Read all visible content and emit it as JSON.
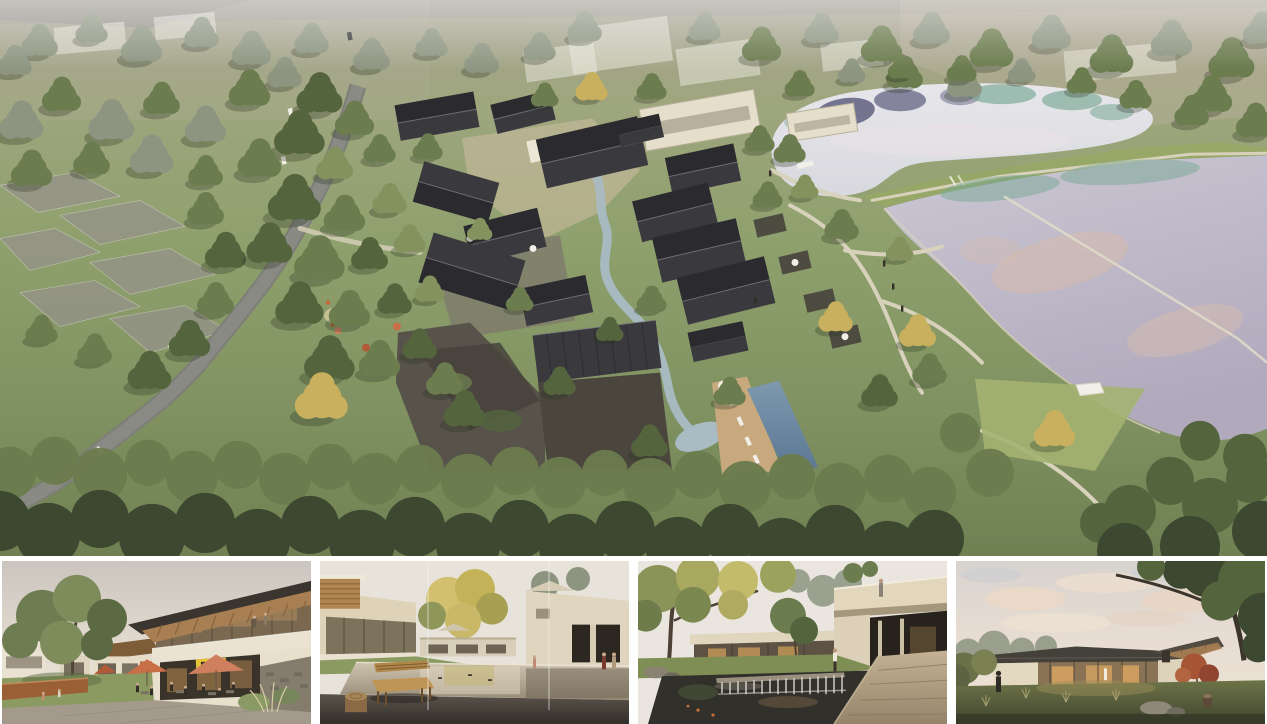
{
  "board": {
    "title": "architecture-rendering-board",
    "panels": {
      "aerial": {
        "label": "aerial-site-rendering",
        "alt": "Aerial rendering of lakeside village resort with winding road, dark gabled courtyard houses along a stream, swimming pool, grass berm and two lakes"
      },
      "plaza": {
        "label": "plaza-street-rendering",
        "alt": "Street view of two-storey timber-roof building with cafe terrace, salmon umbrellas, yellow sign and large tree"
      },
      "pond": {
        "label": "pond-courtyard-rendering",
        "alt": "Courtyard with reflecting pond, wooden bench and log stool, beige houses and golden tree"
      },
      "court": {
        "label": "waterfall-court-rendering",
        "alt": "Courtyard with cantilevered balcony, dark pond with waterfall weir, autumn tree and stone walkway"
      },
      "pavilion": {
        "label": "dusk-pavilion-rendering",
        "alt": "Single-storey glass pavilion glowing at dusk under pink clouds with red maple and dark tree canopy"
      }
    }
  },
  "palette": {
    "haze": "#a7a294",
    "grassA": "#9fa67e",
    "grassB": "#8da06c",
    "grassC": "#7f9160",
    "grassD": "#6f8052",
    "grassLight": "#a4b272",
    "berm": "#97a767",
    "road": "#8a8a84",
    "roofB": "#2b2a2f",
    "roofF": "#3a393e",
    "ridge": "#7b7b84",
    "wall": "#ded3b8",
    "lightRoof": "#e4decb",
    "terrace": "#ece6d6",
    "stone": "#57524a",
    "stoneDark": "#47433c",
    "plazaTan": "#c9bb9e",
    "courtDark": "#4a453d",
    "water": "#a9bcc4",
    "poolA": "#7e98ae",
    "poolB": "#5a7692",
    "deckTan": "#c8a97e",
    "lakeUpA": "#e7e6eb",
    "lakeUpB": "#d8d9de",
    "lakeLoA": "#cbc7d3",
    "lakeLoB": "#b1aabd",
    "lakeTeal": "#78a894",
    "lakeNavy": "#45446a",
    "lakePink": "#d9bcac",
    "path": "#d8d1bb",
    "ghost": "#eceadf",
    "treeDeep": "#3c4830",
    "tree": "#54653e",
    "treeMid": "#6b7c4e",
    "treeLight": "#84925e",
    "treeGray": "#8d9581",
    "treeYellow": "#c9b05e",
    "umbSalmon": "#cf7f5e",
    "umbOrange": "#c96f48",
    "umbRed": "#b05a38",
    "sign": "#e5c438",
    "signGreen": "#5a7a3c",
    "maple": "#a65636",
    "corten": "#9a5f35",
    "wood": "#a87f52",
    "woodDark": "#7e5c38",
    "bench": "#c09454",
    "log": "#8a6a44",
    "figure": "#332e28",
    "whiteish": "#f2efe8",
    "sky1a": "#cbc5bf",
    "sky1b": "#e5ddd1",
    "sky1c": "#efe7d9",
    "sky2": "#e8e3da",
    "sky3": "#eae6df",
    "sky4a": "#d8d3cf",
    "sky4b": "#e7dcd2",
    "sky4c": "#eee3d4",
    "cloudPink": "#ecd8c6",
    "cloudBlue": "#c7cbd1",
    "glassWarm": "#7a6950",
    "glassDark": "#3a332a",
    "glow": "#d8a05c",
    "pave": "#a39a8c",
    "stoneWall": "#847d6d",
    "wallWarm": "#e8e0cd",
    "lawn": "#7e8e54",
    "lawn2": "#8a9a60",
    "pondDark": "#32302a",
    "walkA": "#c3b295",
    "walkB": "#96846a",
    "reflA": "#cfc4b0",
    "reflB": "#958a76",
    "fgDeckA": "#5a544c",
    "fgDeckB": "#332e28"
  }
}
